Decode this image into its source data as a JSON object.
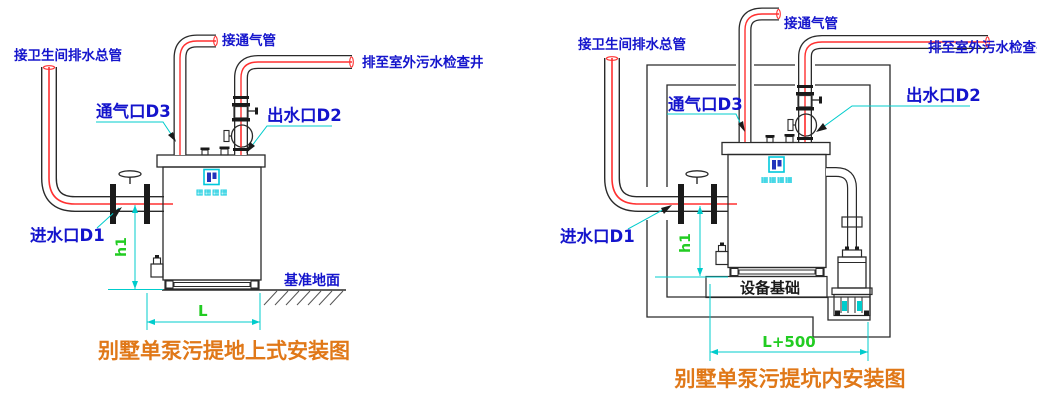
{
  "colors": {
    "label_blue": "#1414cc",
    "leader_cyan": "#00cccc",
    "dim_green": "#22cc22",
    "title_orange": "#e07818",
    "pipe_red": "#ff3030",
    "line_black": "#2a2a2a",
    "logo_cyan": "#00c8dc",
    "logo_navy": "#2233bb",
    "text_black": "#1a1a1a"
  },
  "left": {
    "title": "别墅单泵污提地上式安装图",
    "labels": {
      "drain_main": "接卫生间排水总管",
      "vent_conn": "接通气管",
      "discharge": "排至室外污水检查井",
      "vent_port": "通气口D3",
      "outlet_port": "出水口D2",
      "inlet_port": "进水口D1",
      "ground": "基准地面"
    },
    "dims": {
      "height": "h1",
      "length": "L"
    },
    "logo_text": "▦▦▦▦"
  },
  "right": {
    "title": "别墅单泵污提坑内安装图",
    "labels": {
      "drain_main": "接卫生间排水总管",
      "vent_conn": "接通气管",
      "discharge": "排至室外污水检查井",
      "vent_port": "通气口D3",
      "outlet_port": "出水口D2",
      "inlet_port": "进水口D1",
      "foundation": "设备基础"
    },
    "dims": {
      "height": "h1",
      "length": "L+500"
    },
    "logo_text": "▦▦▦▦"
  }
}
